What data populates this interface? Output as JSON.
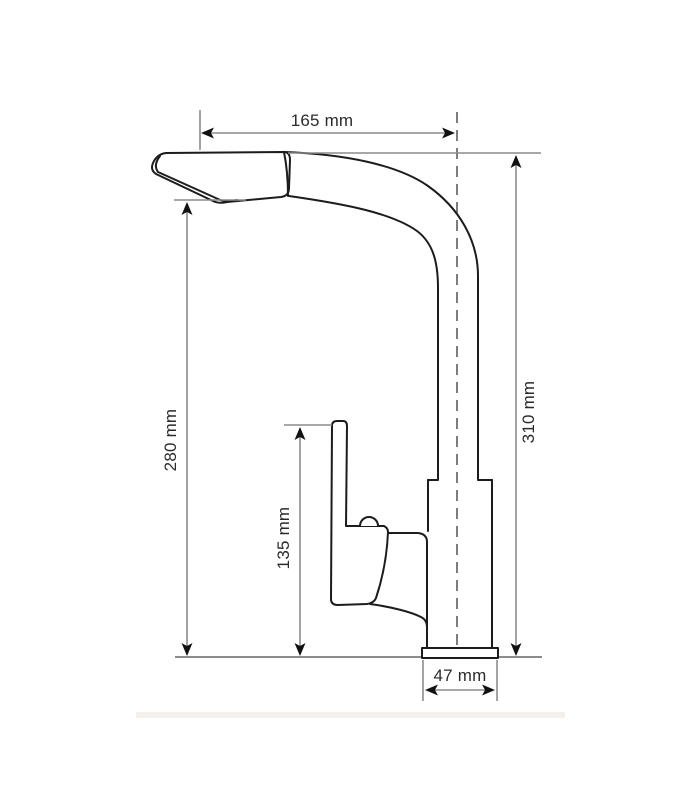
{
  "drawing": {
    "dimensions": {
      "spout_reach": "165 mm",
      "spout_tip_height": "280 mm",
      "total_height": "310 mm",
      "handle_height": "135 mm",
      "base_width": "47 mm"
    },
    "colors": {
      "outline": "#1c1c1c",
      "dimension_line": "#8c8c8c",
      "label_text": "#2b2b2b",
      "centerline": "#7d7d7d",
      "arrow": "#111111",
      "footer_strip": "#f4f1ec"
    }
  }
}
